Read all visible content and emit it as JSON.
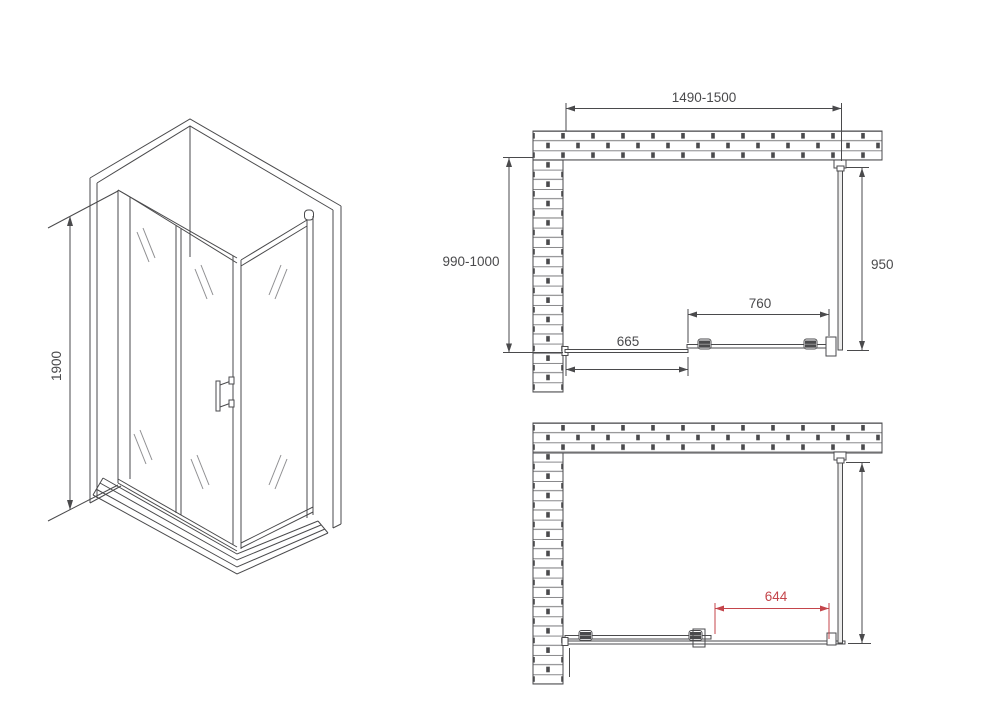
{
  "drawing": {
    "type": "shower-enclosure-installation-diagram",
    "colors": {
      "line": "#4a4a4c",
      "brick_outline": "#77777a",
      "brick_joint": "#4a4a4c",
      "accent_red": "#c4454b",
      "glass_fill": "#ededed",
      "background": "#ffffff"
    },
    "views": {
      "isometric": {
        "dimensions": {
          "height": "1900"
        }
      },
      "plan_upper": {
        "dimensions": {
          "overall_width": "1490-1500",
          "depth": "990-1000",
          "side_panel": "950",
          "sliding_door": "760",
          "fixed_panel": "665"
        }
      },
      "plan_lower": {
        "dimensions": {
          "door_opening": "644"
        }
      }
    }
  }
}
